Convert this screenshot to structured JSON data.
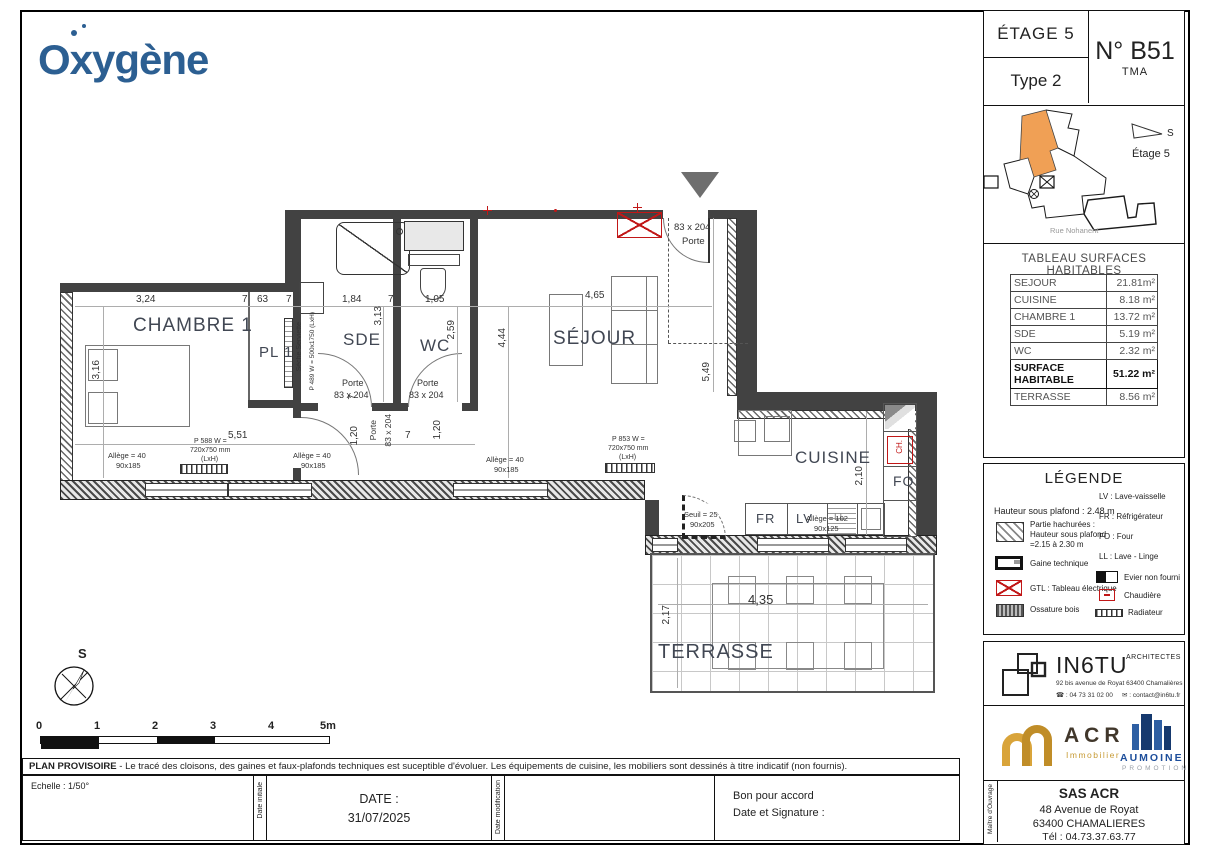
{
  "brand": {
    "name": "Oxygène"
  },
  "unit": {
    "floor": "ÉTAGE 5",
    "type": "Type 2",
    "number": "N° B51",
    "sub": "TMA"
  },
  "sitemap": {
    "compass": "S",
    "floor": "Étage 5",
    "street": "Rue Nohanent"
  },
  "surfaces": {
    "title": "TABLEAU SURFACES HABITABLES",
    "rows": [
      {
        "label": "SEJOUR",
        "value": "21.81m²"
      },
      {
        "label": "CUISINE",
        "value": "8.18 m²"
      },
      {
        "label": "CHAMBRE 1",
        "value": "13.72 m²"
      },
      {
        "label": "SDE",
        "value": "5.19 m²"
      },
      {
        "label": "WC",
        "value": "2.32 m²"
      },
      {
        "label": "SURFACE HABITABLE",
        "value": "51.22 m²"
      },
      {
        "label": "TERRASSE",
        "value": "8.56 m²"
      }
    ]
  },
  "legend": {
    "title": "LÉGENDE",
    "ceiling": "Hauteur sous plafond : 2.48 m",
    "hatched": "Partie hachurées :\nHauteur sous plafond\n=2.15 à 2.30 m",
    "gaine": "Gaine technique",
    "gtl": "GTL : Tableau électrique",
    "ossature": "Ossature bois",
    "lv": "LV : Lave-vaisselle",
    "fr": "FR : Réfrigérateur",
    "fo": "FO : Four",
    "ll": "LL : Lave - Linge",
    "evier": "Evier non fourni",
    "chaudiere": "Chaudière",
    "radiateur": "Radiateur"
  },
  "plan": {
    "rooms": {
      "chambre1": "CHAMBRE 1",
      "pl1": "PL 1",
      "sde": "SDE",
      "wc": "WC",
      "sejour": "SÉJOUR",
      "cuisine": "CUISINE",
      "terrasse": "TERRASSE"
    },
    "appliances": {
      "fr": "FR",
      "lv": "LV",
      "fo": "FO",
      "ch": "CH.",
      "ll": "LL"
    },
    "dims": {
      "d324": "3,24",
      "d7": "7",
      "d63": "63",
      "d184": "1,84",
      "d105": "1,05",
      "d465": "4,65",
      "d316": "3,16",
      "d313": "3,13",
      "d259": "2,59",
      "d444": "4,44",
      "d549": "5,49",
      "d551": "5,51",
      "d210": "2,10",
      "d435": "4,35",
      "d217": "2,17",
      "d120": "1,20"
    },
    "doors": {
      "porte": "Porte",
      "size": "83 x 204",
      "seuil": "Seuil = 25",
      "seuil_size": "90x205"
    },
    "windows": {
      "allege40": "Allège = 40",
      "size185": "90x185",
      "allege102": "Allège = 102",
      "size125": "90x125"
    },
    "radiators": {
      "r1": "P 588 W =",
      "r2": "P 853 W =",
      "size": "720x750 mm",
      "lxh": "(LxH)",
      "towel": "Sèche Serviette",
      "towel_spec": "P 489 W = 500x1750 (LxH)"
    }
  },
  "scalebar": {
    "ticks": [
      "0",
      "1",
      "2",
      "3",
      "4",
      "5m"
    ]
  },
  "compass": {
    "label": "S"
  },
  "footer": {
    "disclaimer_title": "PLAN PROVISOIRE",
    "disclaimer_text": " - Le tracé des cloisons, des gaines et faux-plafonds techniques est suceptible d'évoluer. Les équipements de cuisine, les mobiliers sont dessinés à titre indicatif (non fournis).",
    "echelle": "Echelle : 1/50°",
    "date_initiale": "Date initiale",
    "date_label": "DATE :",
    "date_value": "31/07/2025",
    "date_modification": "Date modification",
    "accord1": "Bon pour accord",
    "accord2": "Date et Signature :"
  },
  "architect": {
    "name": "IN6TU",
    "title": "ARCHITECTES",
    "address": "92 bis avenue de Royat 63400 Chamalières",
    "phone": "☎ : 04 73 31 02 00",
    "email": "✉ : contact@in6tu.fr"
  },
  "promo": {
    "acr": "ACR",
    "acr_sub": "Immobilier",
    "aumoine": "AUMOINE",
    "aumoine_sub": "PROMOTION"
  },
  "owner": {
    "role": "Maître d'Ouvrage",
    "name": "SAS ACR",
    "addr1": "48 Avenue de Royat",
    "addr2": "63400 CHAMALIERES",
    "tel": "Tél : 04.73.37.63.77"
  }
}
